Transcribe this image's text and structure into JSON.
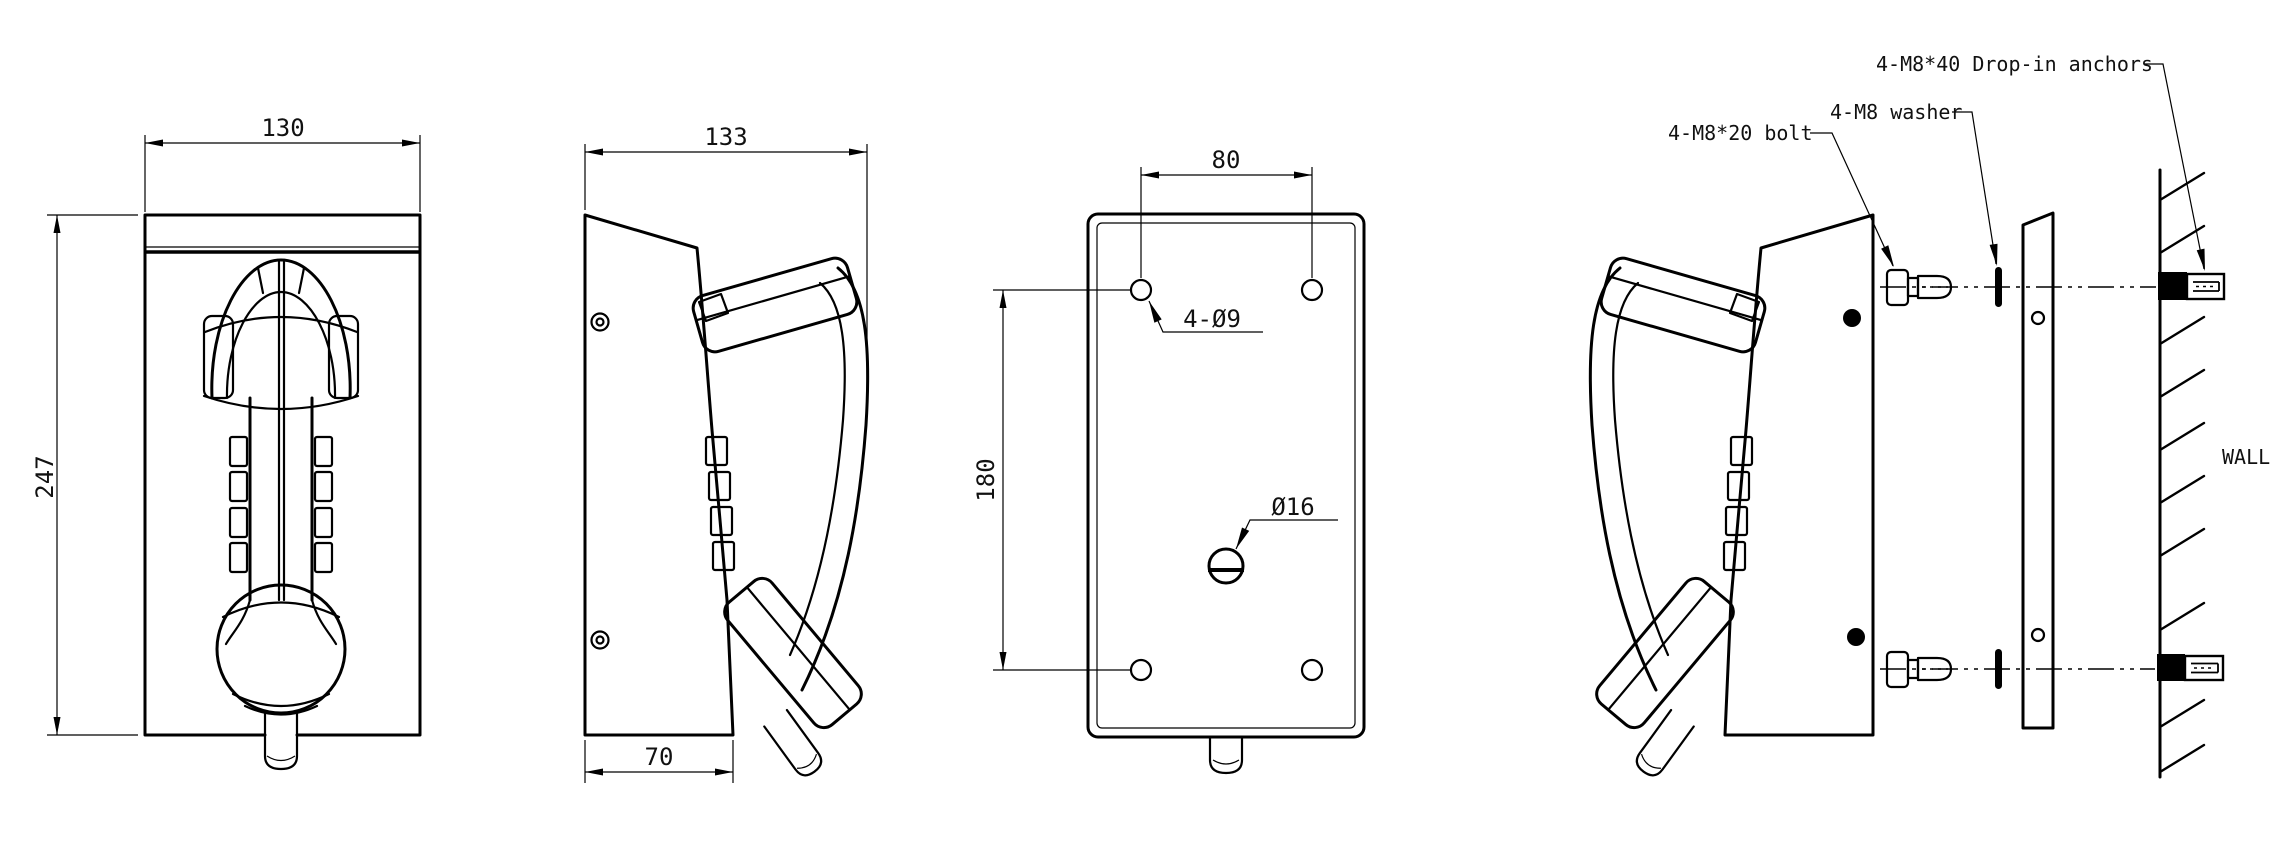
{
  "drawing": {
    "background": "#ffffff",
    "ink": "#000000",
    "views": {
      "front": {
        "dim_width": "130",
        "dim_height": "247"
      },
      "side": {
        "dim_depth": "133",
        "dim_base_depth": "70"
      },
      "back_plate": {
        "dim_hole_spacing_horizontal": "80",
        "dim_hole_spacing_vertical": "180",
        "label_mounting_holes": "4-Ø9",
        "label_cable_hole": "Ø16"
      },
      "installation": {
        "label_bolt": "4-M8*20 bolt",
        "label_washer": "4-M8 washer",
        "label_anchors": "4-M8*40 Drop-in anchors",
        "label_wall": "WALL"
      }
    }
  }
}
